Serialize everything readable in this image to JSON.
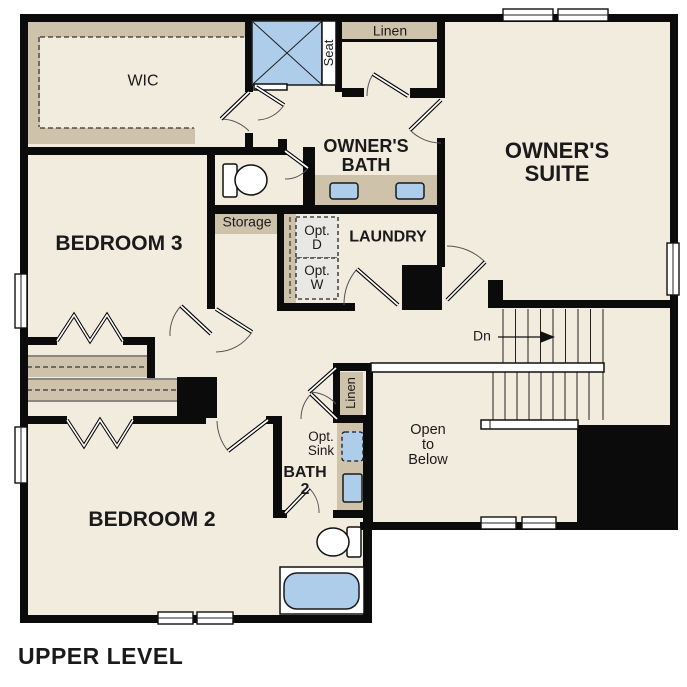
{
  "plan": {
    "title": "UPPER LEVEL",
    "labels": {
      "wic": "WIC",
      "seat": "Seat",
      "linen_upper": "Linen",
      "owners_bath": [
        "OWNER'S",
        "BATH"
      ],
      "owners_suite": [
        "OWNER'S",
        "SUITE"
      ],
      "bedroom3": "BEDROOM 3",
      "storage": "Storage",
      "opt_dryer": [
        "Opt.",
        "D"
      ],
      "opt_washer": [
        "Opt.",
        "W"
      ],
      "laundry": "LAUNDRY",
      "down": "Dn",
      "open_to_below": [
        "Open",
        "to",
        "Below"
      ],
      "linen_lower": "Linen",
      "opt_sink": [
        "Opt.",
        "Sink"
      ],
      "bath2": [
        "BATH",
        "2"
      ],
      "bedroom2": "BEDROOM 2"
    },
    "colors": {
      "floor": "#f2ecdf",
      "wall": "#0b0b0b",
      "tan": "#cfc2ab",
      "fixture_blue": "#aecdeb",
      "unit_gray": "#e9e8e4",
      "outside": "#ffffff"
    }
  }
}
